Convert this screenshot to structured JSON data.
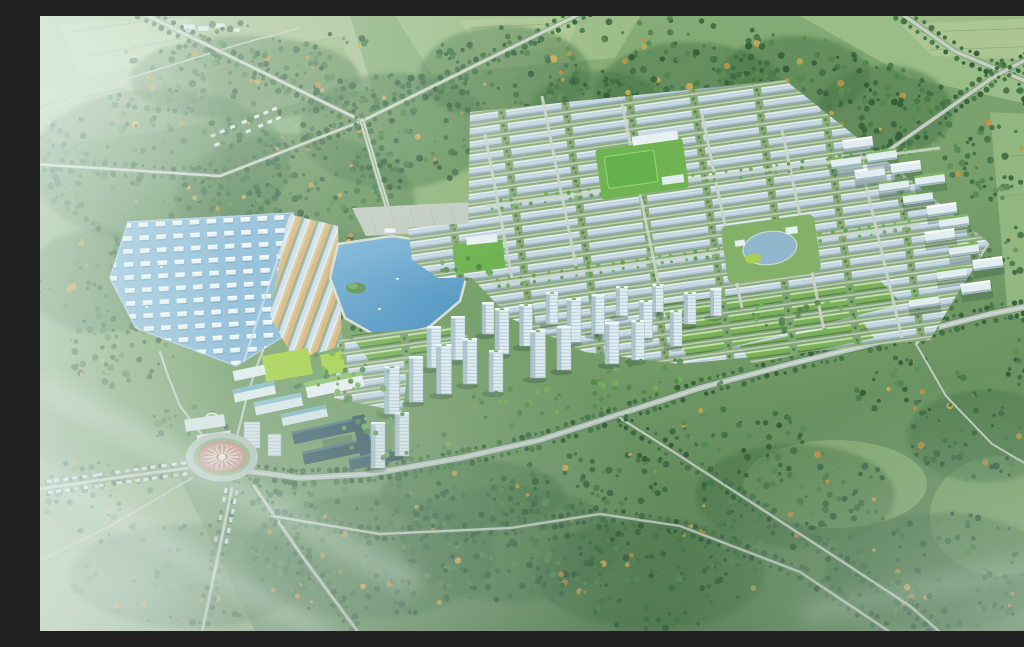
{
  "scene": {
    "caption": "Aerial 3D masterplan rendering of a green township: rows of white marina villas on a blue lagoon and a central lake to the west, a dense grid of pale shophouse blocks in the middle, mid-rise blocks with green roofs along the east edge, a band of white high-rise towers along the southern boulevard, an office campus and a dark mid-rise complex beside a circular sun-plaza roundabout, all surrounded by forest, farmland and tree-lined highways.",
    "landmarks": [
      {
        "name": "marina-villa-district",
        "label": "Marina villa rows on blue lagoon"
      },
      {
        "name": "central-lake",
        "label": "Central lake with green island"
      },
      {
        "name": "entrance-plaza",
        "label": "Entrance parking plaza"
      },
      {
        "name": "shophouse-grid",
        "label": "Shophouse grid district"
      },
      {
        "name": "school-field",
        "label": "School sports fields"
      },
      {
        "name": "round-pond-park",
        "label": "Round pond park"
      },
      {
        "name": "east-midrise-blocks",
        "label": "East edge mid-rise blocks"
      },
      {
        "name": "greenroof-rows",
        "label": "Green-roofed rowhouses"
      },
      {
        "name": "highrise-band",
        "label": "High-rise tower band"
      },
      {
        "name": "office-campus",
        "label": "Office and commercial campus"
      },
      {
        "name": "dark-midrise-complex",
        "label": "Dark mid-rise complex"
      },
      {
        "name": "sun-plaza-roundabout",
        "label": "Sun plaza roundabout"
      },
      {
        "name": "forest-belt",
        "label": "Surrounding forest belt"
      },
      {
        "name": "farmland",
        "label": "Farmland patchwork"
      },
      {
        "name": "highway",
        "label": "Tree-lined highways"
      }
    ]
  },
  "palette": {
    "land": "#7aa169",
    "field_light": "#aac48d",
    "forest_dark": "#2f5a33",
    "lagoon": "#84b6d8",
    "lake": "#5e9dcb",
    "road": "#c9d3c8",
    "house_pale": "#c3d4de",
    "house_ridge": "#eef4f7",
    "roof_green": "#7db457",
    "tower_face": "#e3eef4",
    "tower_shade": "#9db5c2",
    "street_tan": "#e0b377",
    "plaza_pink": "#d2938a",
    "lawn_lime": "#a6d13f",
    "haze": "#eaf6f4"
  }
}
